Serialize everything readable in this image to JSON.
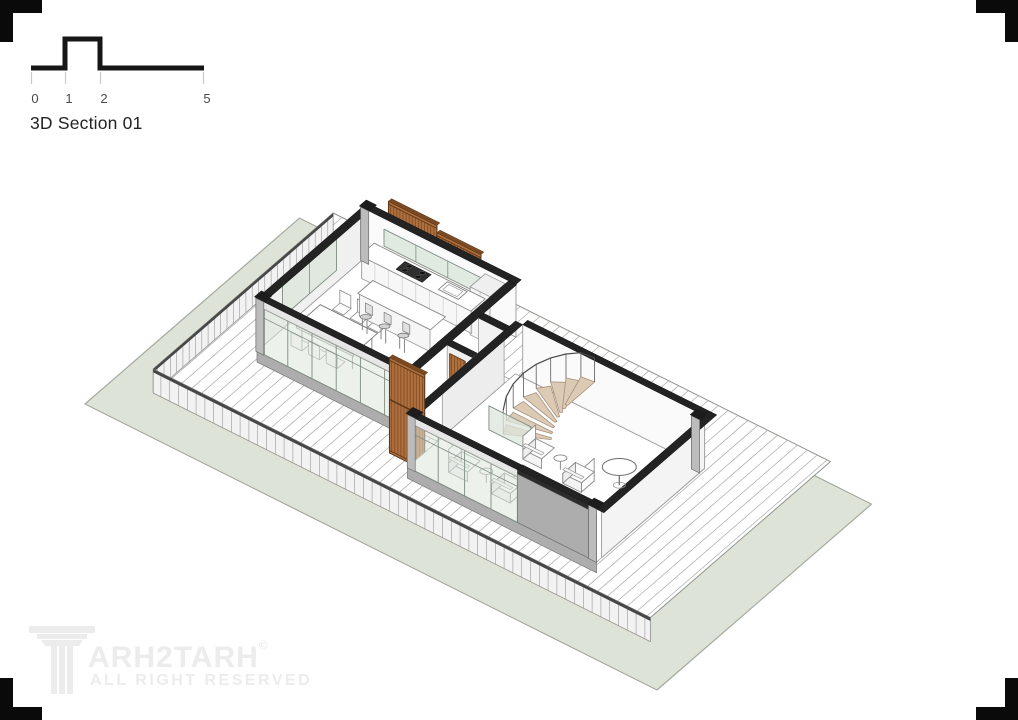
{
  "scale_bar": {
    "unit_labels": [
      "0",
      "1",
      "2",
      "5"
    ],
    "title": "3D Section 01"
  },
  "watermark": {
    "brand": "ARH2TARH",
    "copyright_symbol": "©",
    "tagline": "ALL RIGHT RESERVED",
    "logo": "column-icon"
  },
  "colors": {
    "corner": "#0a0a0a",
    "scalebar": "#161616",
    "tick": "#c9c9c9",
    "label": "#4a4a4a",
    "title": "#232323",
    "watermark": "#ececec",
    "ground": "#dee3d7",
    "groundEdge": "#a3aa9e",
    "deckLine": "#a9a9a9",
    "deckEdge": "#8f948c",
    "skirt": "#f2f2f2",
    "skirtLine": "#909090",
    "band": "#474747",
    "wallWhite": "#fafafa",
    "wallLight": "#f0f0f0",
    "wallGray": "#adadad",
    "wallEnd": "#cfcfcf",
    "cap": "#232323",
    "glass": "#dce6dc",
    "mullion": "#7e8d82",
    "wood": "#b06f3e",
    "woodDark": "#7b4a22",
    "woodFrame": "#5d3718",
    "tread": "#dccab5",
    "treadEdge": "#a5917b",
    "furn": "#8a8a8a",
    "stool": "#d3d3d3"
  }
}
